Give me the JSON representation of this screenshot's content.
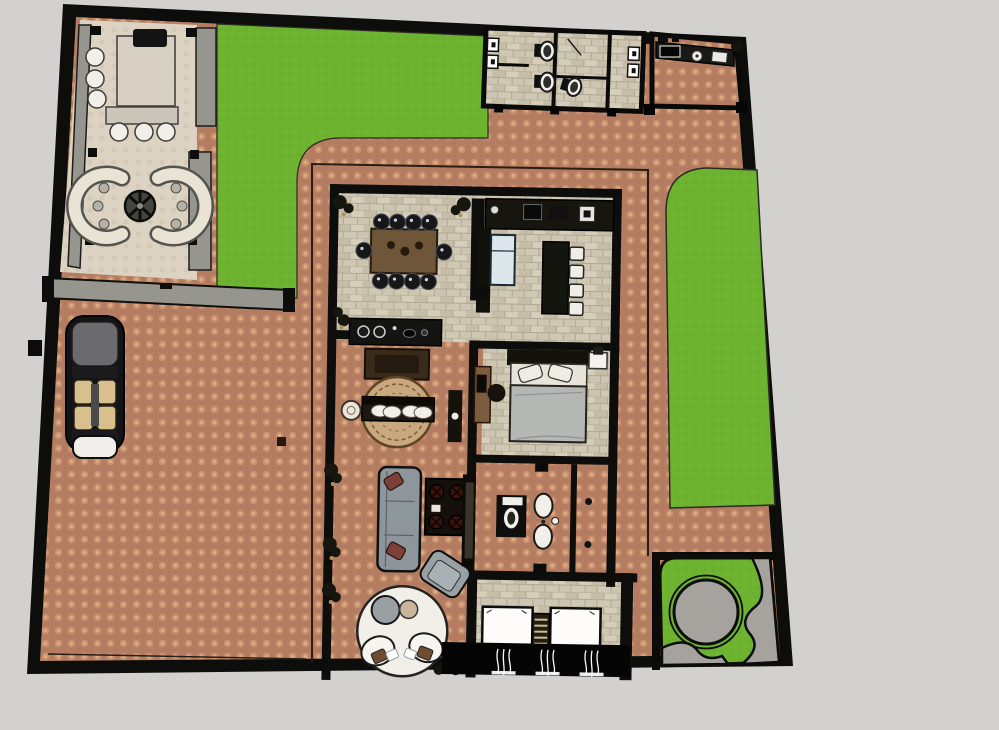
{
  "meta": {
    "description": "Top-down 2D architectural floor plan of a walled residence with courtyard, lawns and gardens"
  },
  "palette": {
    "background": "#d3d1ce",
    "wall": "#0d0d0b",
    "grass": "#6db32f",
    "terracotta_base": "#b57e62",
    "terracotta_dot": "#d09a74",
    "stone_base": "#cdc5b1",
    "stone_line": "#b1a893",
    "patio_floor": "#ddd3c3",
    "gray_wall": "#96968f",
    "garden_gray": "#a6a29d",
    "sofa_gray": "#8d969b",
    "bed_blanket": "#b4b7b3",
    "wood_brown": "#6f5638",
    "seat_tan": "#d9bf8d",
    "rug_tan": "#c9a87d",
    "white": "#f4f1ea"
  },
  "areas": {
    "compound": {
      "label": "Walled compound"
    },
    "courtyard": {
      "label": "Courtyard driveway"
    },
    "patio": {
      "label": "Patio lounge with fire pit"
    },
    "front_lawn": {
      "label": "Front lawn"
    },
    "side_lawn": {
      "label": "Side lawn"
    },
    "garden": {
      "label": "Corner garden with round plaza"
    },
    "restrooms": {
      "label": "Guest restrooms"
    },
    "outdoor_kitchen": {
      "label": "Outdoor kitchen"
    },
    "dining": {
      "label": "Dining room"
    },
    "kitchen": {
      "label": "Kitchen"
    },
    "bedroom": {
      "label": "Master bedroom"
    },
    "bathroom": {
      "label": "Bathrooms"
    },
    "hallway": {
      "label": "Hallway bench"
    },
    "living": {
      "label": "Living room"
    },
    "nook": {
      "label": "Reading nook"
    },
    "twin_bedroom": {
      "label": "Twin bedroom"
    },
    "car": {
      "label": "Parked car"
    }
  },
  "furniture": {
    "patio": [
      "dining table",
      "6 round chairs",
      "fire pit",
      "2 curved benches"
    ],
    "dining": [
      "wood table",
      "10 chairs",
      "range counter",
      "side table"
    ],
    "kitchen": [
      "wall counter",
      "fridge",
      "island",
      "4 bar stools"
    ],
    "bedroom": [
      "double bed",
      "desk",
      "chair",
      "nightstand"
    ],
    "bathroom": [
      "toilet",
      "double sink vanity"
    ],
    "restrooms": [
      "3 toilets",
      "4 wall fixtures"
    ],
    "living": [
      "sofa",
      "coffee table",
      "armchair",
      "tv console"
    ],
    "hallway": [
      "round rug",
      "bench",
      "side table",
      "console"
    ],
    "nook": [
      "round rug",
      "2 lounge chairs",
      "2 side tables"
    ],
    "twin_bedroom": [
      "2 single beds",
      "ladder shelf",
      "curtained window"
    ],
    "outdoor_kitchen": [
      "grill",
      "sink",
      "counter"
    ]
  }
}
